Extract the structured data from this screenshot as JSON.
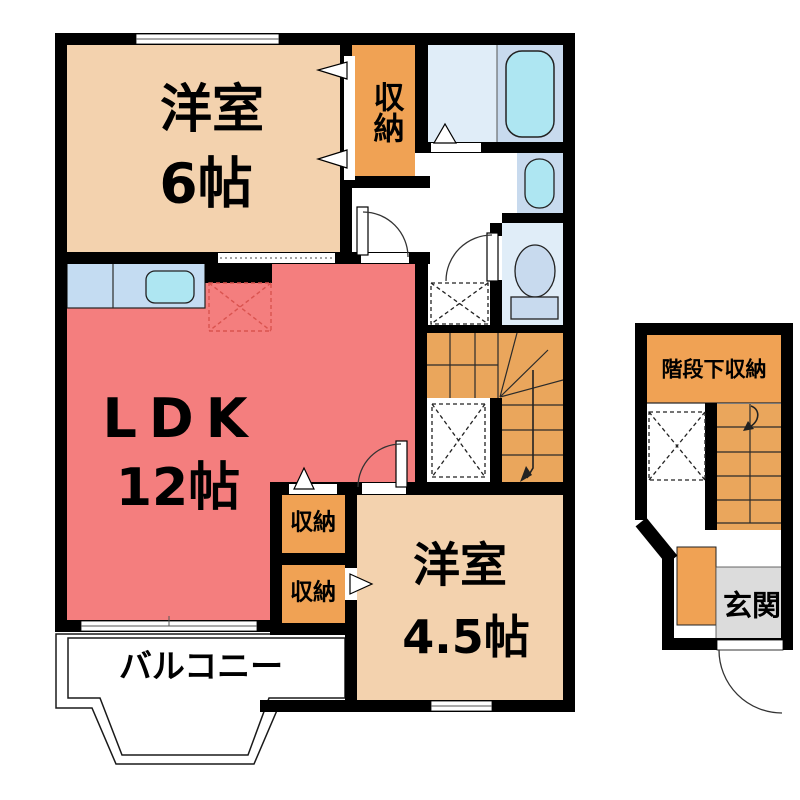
{
  "colors": {
    "wall": "#000000",
    "room_peach": "#f3d2ae",
    "closet_orange": "#f0a254",
    "stairs_orange": "#eaa65c",
    "ldk_red": "#f47e7e",
    "counter_blue": "#c4dcf2",
    "water_cyan": "#aee6f2",
    "fixture_blue": "#c8daee",
    "sanitary_floor": "#e0edf8",
    "balcony_gray": "#d8d2c9",
    "entrance_gray": "#dcdcdc",
    "fridge_dash_red": "#d9534f"
  },
  "plan": {
    "main_floor": {
      "rooms": {
        "western6": {
          "name": "洋室",
          "size": "6帖"
        },
        "closet_top": {
          "name": "収納"
        },
        "ldk": {
          "name": "LDK",
          "size": "12帖"
        },
        "closet_a": {
          "name": "収納"
        },
        "closet_b": {
          "name": "収納"
        },
        "western45": {
          "name": "洋室",
          "size": "4.5帖"
        },
        "balcony": {
          "name": "バルコニー"
        }
      }
    },
    "annex_floor": {
      "rooms": {
        "understairs_storage": {
          "name": "階段下収納"
        },
        "entrance": {
          "name": "玄関"
        }
      }
    }
  }
}
